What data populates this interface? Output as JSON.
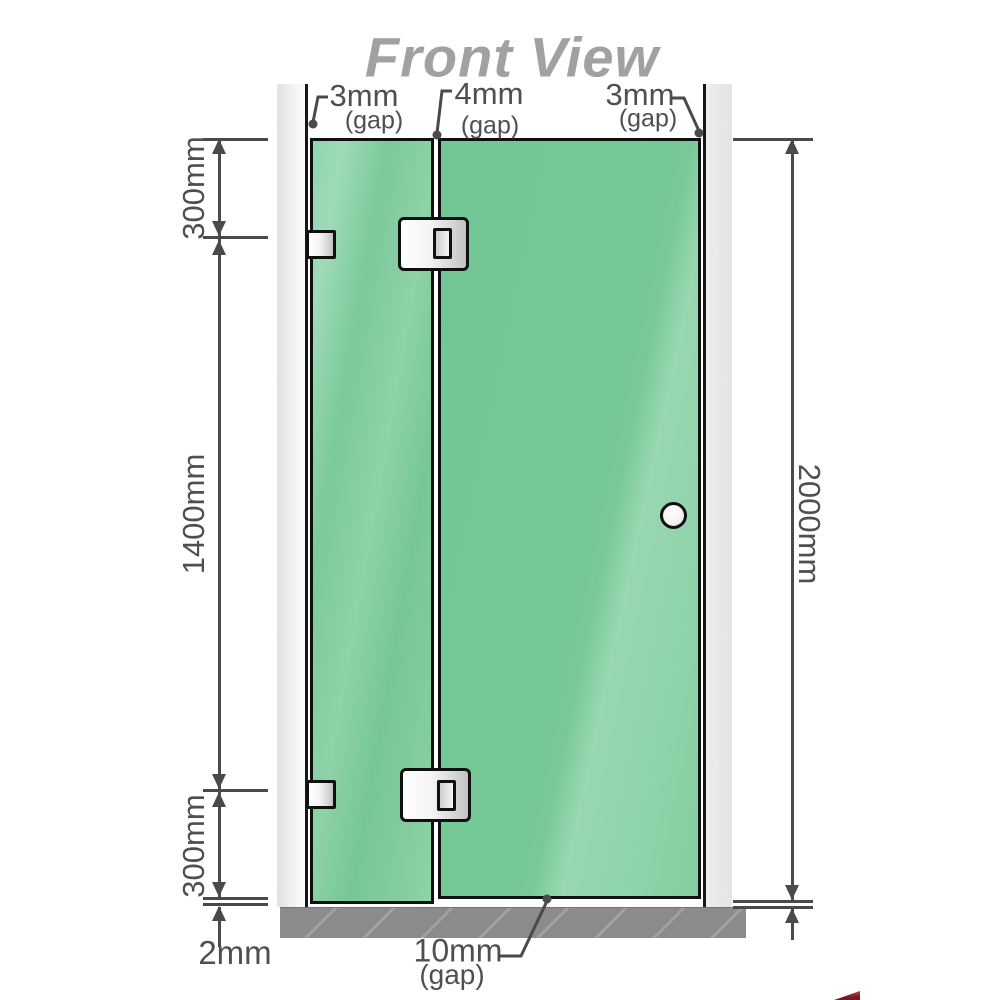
{
  "title": "Front View",
  "top_gap_labels": {
    "left": {
      "value": "3mm",
      "qualifier": "(gap)"
    },
    "middle": {
      "value": "4mm",
      "qualifier": "(gap)"
    },
    "right": {
      "value": "3mm",
      "qualifier": "(gap)"
    }
  },
  "side_dimensions": {
    "left_top": "300mm",
    "left_middle": "1400mm",
    "left_bottom": "300mm",
    "left_floor_gap": "2mm",
    "right_overall": "2000mm"
  },
  "bottom_gap_label": {
    "value": "10mm",
    "qualifier": "(gap)"
  },
  "colors": {
    "glass_green": "#74c795",
    "glass_highlight": "#9cdbb5",
    "wall_gray": "#e6e6e6",
    "floor_gray": "#8b8b8d",
    "dimension_line": "#4a4a4a",
    "label_text": "#4f4f4f",
    "title_gray": "#9fa1a3",
    "metal_fitting": "#d9d9d9",
    "logo_red": "#8e1f2c"
  }
}
